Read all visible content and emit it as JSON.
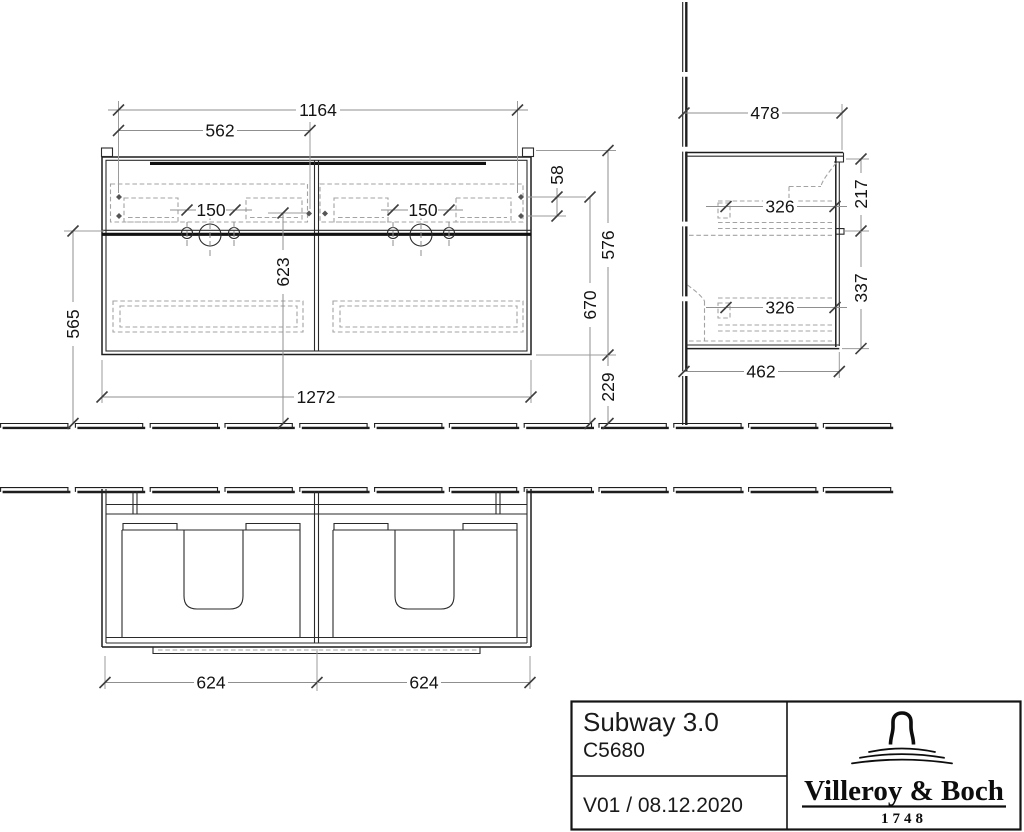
{
  "drawing": {
    "front_view": {
      "dim_width_top": "1164",
      "dim_basin_center": "562",
      "dim_hole_spacing_left": "150",
      "dim_hole_spacing_right": "150",
      "dim_top_offset": "58",
      "dim_cabinet_height": "576",
      "dim_basin_front_height": "623",
      "dim_rim_height": "670",
      "dim_underside_height": "565",
      "dim_width_total": "1272",
      "dim_floor_clearance": "229"
    },
    "side_view": {
      "dim_depth_top": "478",
      "dim_drawer_upper": "326",
      "dim_drawer_lower": "326",
      "dim_front_upper": "217",
      "dim_front_lower": "337",
      "dim_depth_bottom": "462"
    },
    "plan_view": {
      "dim_door_left": "624",
      "dim_door_right": "624"
    }
  },
  "title_block": {
    "series": "Subway 3.0",
    "article": "C5680",
    "version": "V01 / 08.12.2020",
    "logo": {
      "brand": "Villeroy & Boch",
      "year": "1748"
    }
  },
  "colors": {
    "object_line": "#1d1d1d",
    "dimension_line": "#8f8f8f",
    "hidden_line": "#a3a3a3",
    "background": "#ffffff"
  }
}
